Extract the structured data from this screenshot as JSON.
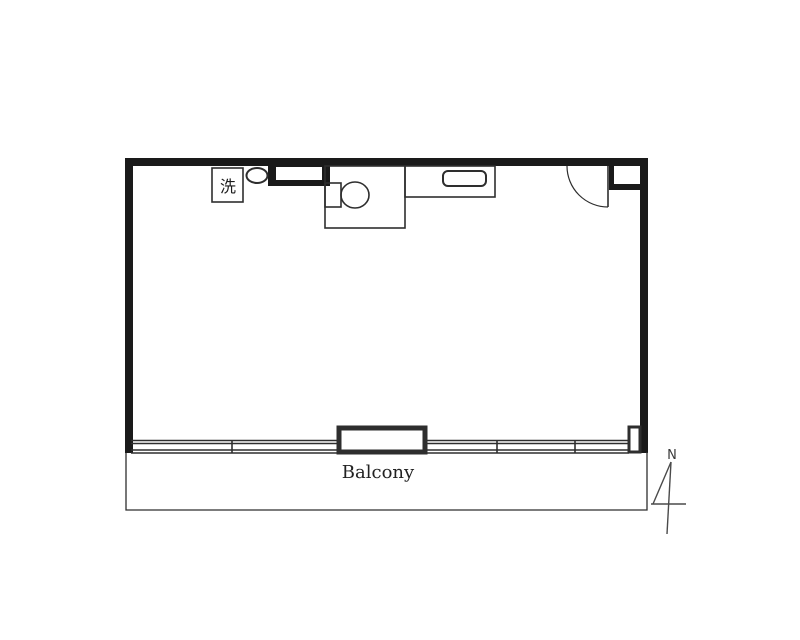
{
  "plan": {
    "type": "floor-plan",
    "labels": {
      "washing_machine": "洗",
      "balcony": "Balcony",
      "north": "N"
    },
    "colors": {
      "wall": "#1a1a1a",
      "line": "#2e2e2e",
      "background": "#ffffff"
    }
  }
}
